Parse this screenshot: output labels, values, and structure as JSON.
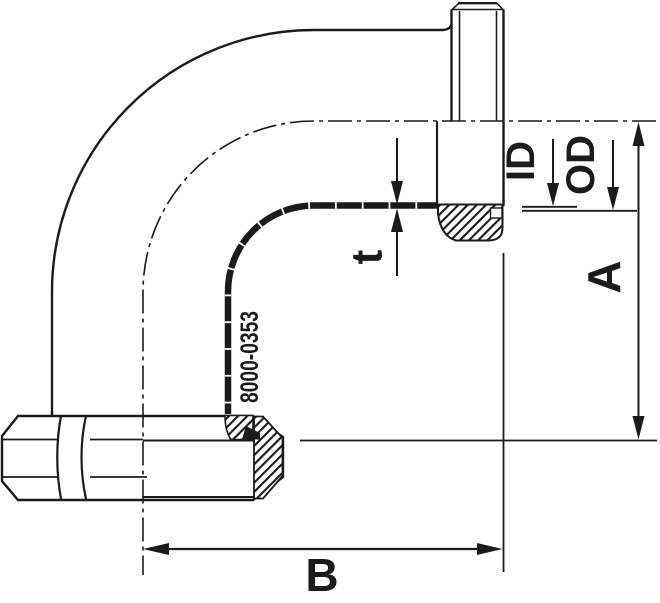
{
  "drawing": {
    "type": "technical-drawing",
    "description": "90 degree bend with male threaded end and union liner nut, section view",
    "part_number": "8000-0353",
    "labels": {
      "t": "t",
      "id": "ID",
      "od": "OD",
      "a": "A",
      "b": "B"
    },
    "colors": {
      "line": "#1b1b1b",
      "background": "#ffffff"
    }
  }
}
